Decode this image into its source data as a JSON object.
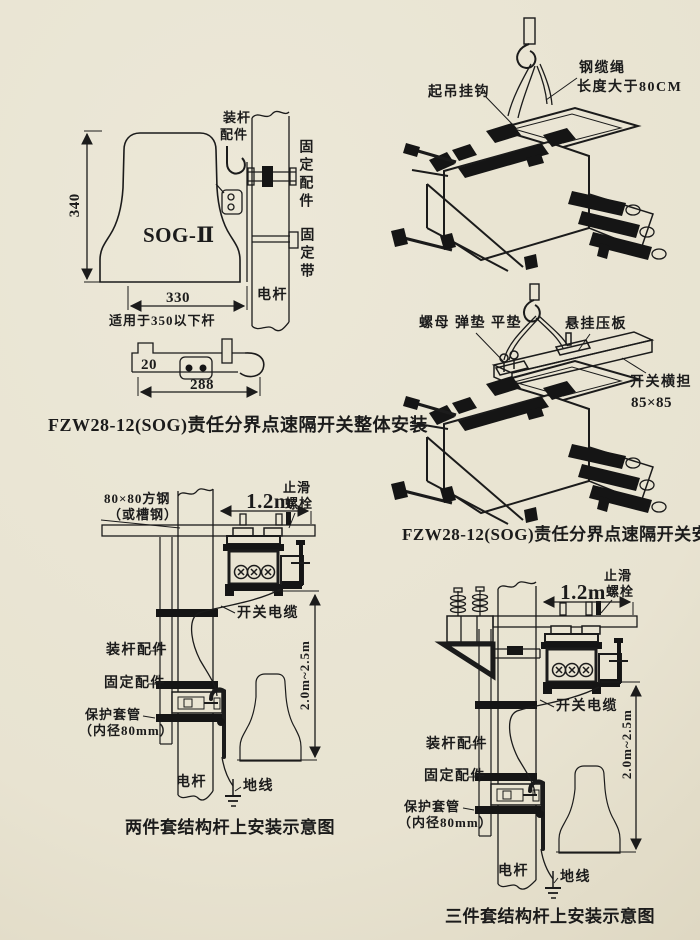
{
  "page": {
    "ink": "#1b1b1b",
    "paper": "#e9e4d2"
  },
  "fig_overall": {
    "device_model": "SOG-Ⅱ",
    "dim_height": "340",
    "dim_width": "330",
    "fit_note": "适用于350以下杆",
    "pole_fitting_l1": "装杆",
    "pole_fitting_l2": "配件",
    "fixing_fitting": "固定配件",
    "fixing_strap": "固定带",
    "pole": "电杆",
    "bracket_dim_step": "20",
    "bracket_dim_length": "288",
    "caption": "FZW28-12(SOG)责任分界点速隔开关整体安装"
  },
  "fig_hoist": {
    "lifting_hook": "起吊挂钩",
    "steel_cable": "钢缆绳",
    "cable_length": "长度大于80CM"
  },
  "fig_crossarm_install": {
    "hardware": "螺母 弹垫 平垫",
    "hanging_plate": "悬挂压板",
    "switch_crossarm": "开关横担",
    "crossarm_size": "85×85",
    "caption": "FZW28-12(SOG)责任分界点速隔开关安装"
  },
  "fig_two_piece": {
    "square_steel_l1": "80×80方钢",
    "square_steel_l2": "（或槽钢）",
    "dim_span": "1.2m",
    "antislip_l1": "止滑",
    "antislip_l2": "螺栓",
    "switch_cable": "开关电缆",
    "pole_fitting": "装杆配件",
    "fixing_fitting": "固定配件",
    "protect_tube_l1": "保护套管",
    "protect_tube_l2": "（内径80mm）",
    "pole": "电杆",
    "ground_wire": "地线",
    "dim_height_range": "2.0m~2.5m",
    "caption": "两件套结构杆上安装示意图"
  },
  "fig_three_piece": {
    "dim_span": "1.2m",
    "antislip_l1": "止滑",
    "antislip_l2": "螺栓",
    "switch_cable": "开关电缆",
    "pole_fitting": "装杆配件",
    "fixing_fitting": "固定配件",
    "protect_tube_l1": "保护套管",
    "protect_tube_l2": "（内径80mm）",
    "pole": "电杆",
    "ground_wire": "地线",
    "dim_height_range": "2.0m~2.5m",
    "caption": "三件套结构杆上安装示意图"
  }
}
